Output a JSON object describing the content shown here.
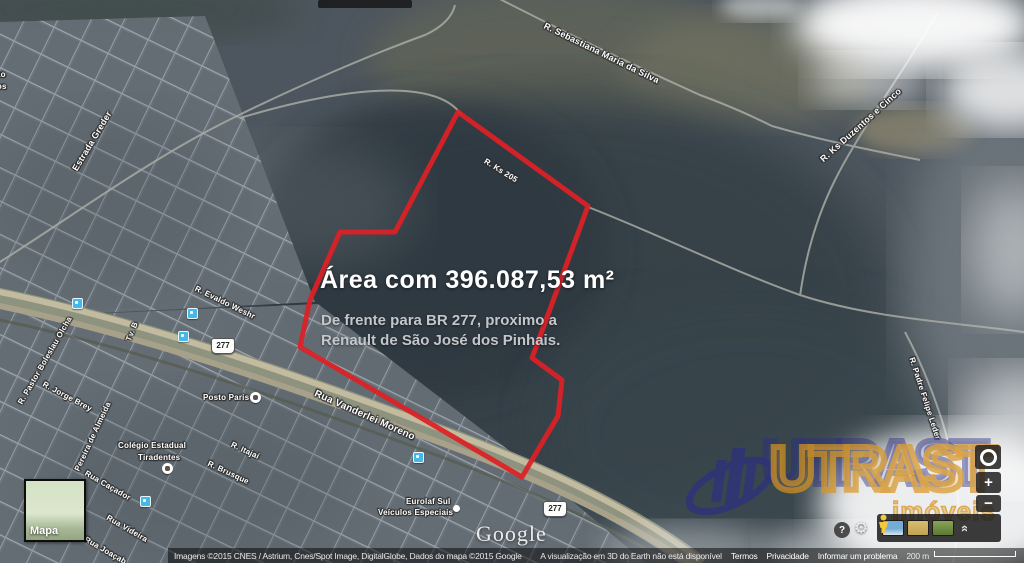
{
  "overlay": {
    "title": "Área  com 396.087,53 m²",
    "line1": "De frente para BR 277, proximo a",
    "line2": "Renault de São José dos Pinhais."
  },
  "map_labels": {
    "sebastiana": "R. Sebastiana Maria da Silva",
    "ks_duzentos": "R. Ks Duzentos e Cinco",
    "estrada_greder": "Estrada Greder",
    "ks205": "R. Ks 205",
    "padre": "R. Padre Felipe Leder",
    "evaldo": "R. Evaldo Weshr",
    "tv_b": "Tv. B",
    "pastor": "R. Pastor Boleslau Olcha",
    "jorge_brey": "R. Jorge Brey",
    "pereira": "Pereira de Almeida",
    "colegio_l1": "Colégio Estadual",
    "colegio_l2": "Tiradentes",
    "cacador": "Rua Caçador",
    "videira": "Rua Videira",
    "joacaba": "Rua Joaçab",
    "itajai": "R. Itajaí",
    "brusque": "R. Brusque",
    "posto": "Posto Paris",
    "vanderlei": "Rua Vanderlei Moreno",
    "eurolaf_l1": "Eurolaf Sul",
    "eurolaf_l2": "Veículos Especiais",
    "cut_l1": "ão",
    "cut_l2": "tos",
    "br277_a": "277",
    "br277_b": "277",
    "google": "Google"
  },
  "watermark": {
    "name": "UTRAST",
    "sub": "imóveis"
  },
  "minimap": {
    "label": "Mapa"
  },
  "controls": {
    "zoom_in": "+",
    "zoom_out": "−"
  },
  "icons": {
    "help": "?",
    "gear": "⚙",
    "collapse": "»"
  },
  "attribution": {
    "imagery": "Imagens ©2015 CNES / Astrium, Cnes/Spot Image, DigitalGlobe, Dados do mapa ©2015 Google",
    "notice": "A visualização em 3D do Earth não está disponível",
    "terms": "Termos",
    "privacy": "Privacidade",
    "report": "Informar um problema",
    "scale": "200 m"
  },
  "colors": {
    "parcel_outline": "#dd2026",
    "highway": "#8d937f",
    "transit_icon": "#45b8ea",
    "brand_orange": "#d89422",
    "brand_blue": "#2c2f83"
  }
}
